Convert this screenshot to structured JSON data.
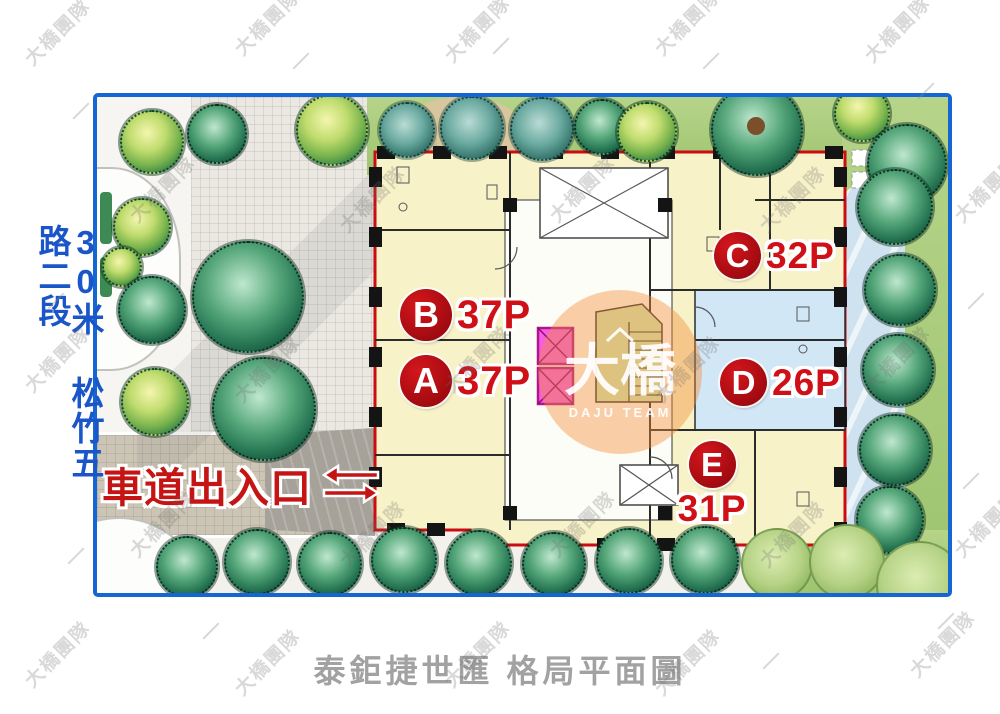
{
  "page": {
    "caption": "泰鉅捷世匯 格局平面圖"
  },
  "road": {
    "label": "30米 松竹五路二段"
  },
  "driveway": {
    "label": "車道出入口"
  },
  "building": {
    "units": [
      {
        "letter": "A",
        "area": "37P"
      },
      {
        "letter": "B",
        "area": "37P"
      },
      {
        "letter": "C",
        "area": "32P"
      },
      {
        "letter": "D",
        "area": "26P"
      },
      {
        "letter": "E",
        "area": "31P"
      }
    ]
  },
  "watermark": {
    "text": "大橋團隊",
    "badge_cn": "大橋",
    "badge_en": "DAJU TEAM"
  },
  "colors": {
    "frame_blue": "#1565d2",
    "road_text_blue": "#1a56c8",
    "accent_red": "#c41414",
    "building_outline_red": "#cc0c10",
    "unit_circle_red": "#ad0d12",
    "unit_fill_cream": "#f7f2c8",
    "unit_d_fill_blue": "#d2e7f6",
    "elevator_magenta": "#f55ee2",
    "stair_green": "#cfeab5",
    "caption_gray": "#a2a2a2"
  }
}
